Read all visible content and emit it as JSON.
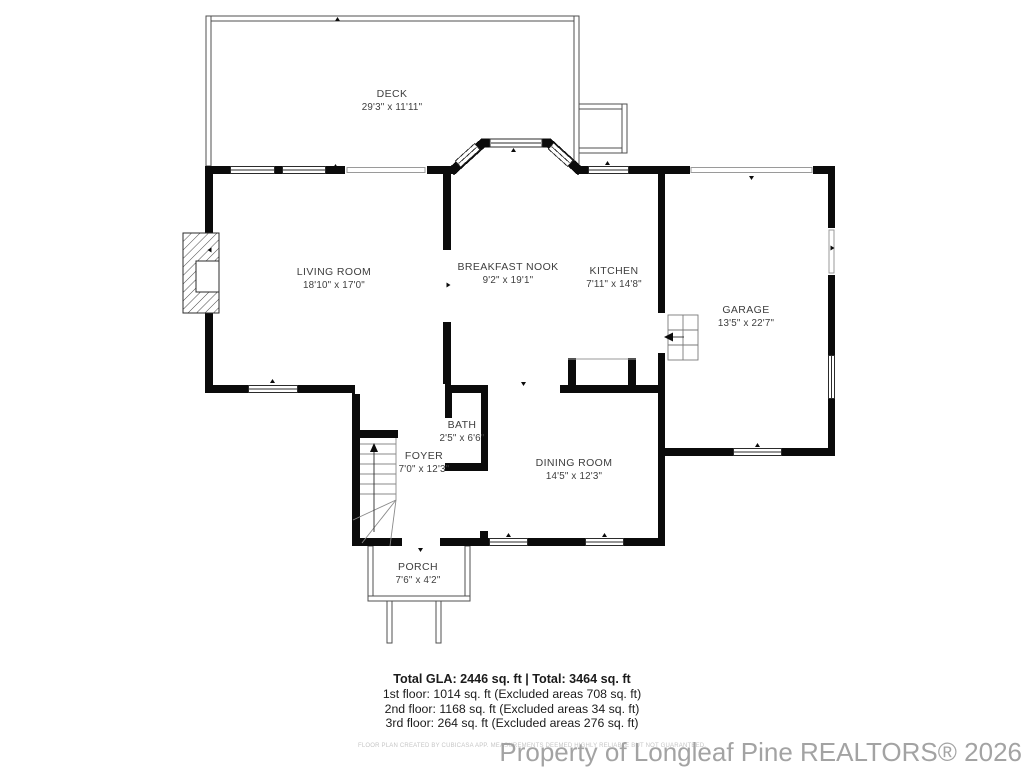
{
  "rooms": {
    "deck": {
      "name": "DECK",
      "dims": "29'3\" x 11'11\""
    },
    "living": {
      "name": "LIVING ROOM",
      "dims": "18'10\" x 17'0\""
    },
    "nook": {
      "name": "BREAKFAST NOOK",
      "dims": "9'2\" x 19'1\""
    },
    "kitchen": {
      "name": "KITCHEN",
      "dims": "7'11\" x 14'8\""
    },
    "garage": {
      "name": "GARAGE",
      "dims": "13'5\" x 22'7\""
    },
    "bath": {
      "name": "BATH",
      "dims": "2'5\" x 6'6\""
    },
    "foyer": {
      "name": "FOYER",
      "dims": "7'0\" x 12'3\""
    },
    "dining": {
      "name": "DINING ROOM",
      "dims": "14'5\" x 12'3\""
    },
    "porch": {
      "name": "PORCH",
      "dims": "7'6\" x 4'2\""
    }
  },
  "summary": {
    "total": "Total GLA: 2446 sq. ft | Total: 3464 sq. ft",
    "floor1": "1st floor: 1014 sq. ft (Excluded areas 708 sq. ft)",
    "floor2": "2nd floor: 1168 sq. ft (Excluded areas 34 sq. ft)",
    "floor3": "3rd floor: 264 sq. ft (Excluded areas 276 sq. ft)"
  },
  "disclaimer": "FLOOR PLAN CREATED BY CUBICASA APP. MEASUREMENTS DEEMED HIGHLY RELIABLE BUT NOT GUARANTEED.",
  "watermark": "Property of Longleaf Pine REALTORS® 2026",
  "colors": {
    "wall": "#0b0b0b",
    "thin_line": "#555555",
    "label_text": "#3e3e3e",
    "watermark_gray": "#9a9a9a"
  }
}
